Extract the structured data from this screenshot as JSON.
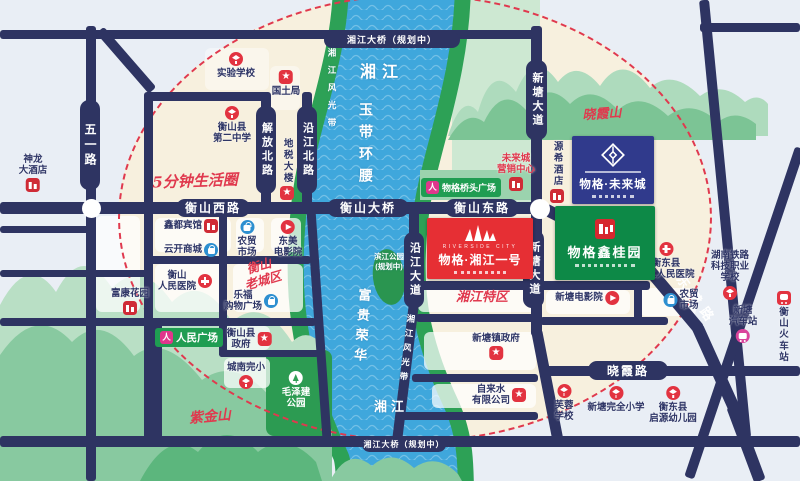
{
  "title": "物格·未来城 区位图",
  "roads": {
    "wuyi": "五一路",
    "jiefangbei": "解放北路",
    "yanjiangbei": "沿江北路",
    "hengshanxi": "衡山西路",
    "hengshanbridge": "衡山大桥",
    "hengshandong": "衡山东路",
    "xintang_n": "新塘大道",
    "xintang_s": "新塘大道",
    "yanjiangda": "沿江大道",
    "xiaoxialu": "晓霞路",
    "dongjianlu": "东健路",
    "xjbridge_top": "湘江大桥（规划中）",
    "xjbridge_bottom": "湘江大桥（规划中）"
  },
  "river": {
    "name_top": "湘江",
    "name_bottom": "湘江",
    "belt_west": "湘江风光带",
    "belt_east": "湘江风光带",
    "yudai": "玉带环腰",
    "fugui": "富贵荣华",
    "island": "滨江公园\n(规划中)"
  },
  "scripts": {
    "five_min": "5分钟生活圈",
    "old_town": "衡山\n老城区",
    "zijinshan": "紫金山",
    "xiaoxiashan": "晓霞山",
    "xjtequ": "湘江特区"
  },
  "projects": {
    "future": {
      "name": "物格·未来城"
    },
    "riverside": {
      "eyebrow": "RIVERSIDE CITY",
      "name": "物格·湘江一号"
    },
    "xingui": {
      "name": "物格鑫桂园"
    }
  },
  "plazas": {
    "renmin": "人民广场",
    "qiaotou": "物格桥头广场"
  },
  "pois": [
    {
      "label": "实验学校",
      "icon": "school",
      "pos": "top",
      "x": 236,
      "y": 52
    },
    {
      "label": "国土局",
      "icon": "star",
      "pos": "top",
      "x": 286,
      "y": 70
    },
    {
      "label": "衡山县\n第二中学",
      "icon": "school",
      "pos": "top",
      "x": 232,
      "y": 106
    },
    {
      "label": "地税大楼",
      "icon": "star",
      "pos": "bottom",
      "x": 287,
      "y": 138,
      "vert": true
    },
    {
      "label": "神龙\n大酒店",
      "icon": "hotel",
      "pos": "bottom",
      "x": 33,
      "y": 154
    },
    {
      "label": "鑫都宾馆",
      "icon": "hotel",
      "pos": "right",
      "x": 191,
      "y": 219
    },
    {
      "label": "云开商城",
      "icon": "shop",
      "pos": "right",
      "x": 191,
      "y": 243
    },
    {
      "label": "农贸\n市场",
      "icon": "shop",
      "pos": "top",
      "x": 247,
      "y": 220
    },
    {
      "label": "东美\n电影院",
      "icon": "cine",
      "pos": "top",
      "x": 288,
      "y": 220
    },
    {
      "label": "衡山\n人民医院",
      "icon": "hosp",
      "pos": "right",
      "x": 185,
      "y": 270
    },
    {
      "label": "乐福\n购物广场",
      "icon": "shop",
      "pos": "right",
      "x": 251,
      "y": 290
    },
    {
      "label": "富康花园",
      "icon": "bldg",
      "pos": "bottom",
      "x": 130,
      "y": 288
    },
    {
      "label": "衡山县\n政府",
      "icon": "star",
      "pos": "right",
      "x": 249,
      "y": 328
    },
    {
      "label": "城南完小",
      "icon": "school",
      "pos": "bottom",
      "x": 246,
      "y": 362
    },
    {
      "label": "毛泽建\n公园",
      "icon": "tree",
      "pos": "top",
      "x": 296,
      "y": 371,
      "cls": "on-green"
    },
    {
      "label": "新塘镇政府",
      "icon": "star",
      "pos": "bottom",
      "x": 496,
      "y": 333
    },
    {
      "label": "自来水\n有限公司",
      "icon": "star",
      "pos": "right",
      "x": 499,
      "y": 384
    },
    {
      "label": "芙蓉\n学校",
      "icon": "school",
      "pos": "top",
      "x": 564,
      "y": 384
    },
    {
      "label": "新塘完全小学",
      "icon": "school",
      "pos": "top",
      "x": 616,
      "y": 386
    },
    {
      "label": "衡东县\n启源幼儿园",
      "icon": "school",
      "pos": "top",
      "x": 673,
      "y": 386
    },
    {
      "label": "新塘电影院",
      "icon": "cine",
      "pos": "right",
      "x": 587,
      "y": 291
    },
    {
      "label": "农贸\n市场",
      "icon": "shop",
      "pos": "left",
      "x": 681,
      "y": 289
    },
    {
      "label": "衡东县\n第二人民医院",
      "icon": "hosp",
      "pos": "top",
      "x": 666,
      "y": 242
    },
    {
      "label": "湖南铁路\n科技职业\n学校",
      "icon": "school",
      "pos": "bottom",
      "x": 730,
      "y": 250
    },
    {
      "label": "新塘\n汽车站",
      "icon": "bus",
      "pos": "bottom",
      "x": 743,
      "y": 305
    },
    {
      "label": "衡山\n火车站",
      "icon": "train",
      "pos": "top",
      "x": 784,
      "y": 291
    },
    {
      "label": "源希酒店",
      "icon": "hotel",
      "pos": "bottom",
      "x": 557,
      "y": 141,
      "vert": true
    },
    {
      "label": "未来城\n营销中心",
      "icon": "bldg",
      "pos": "bottom",
      "x": 516,
      "y": 153,
      "cls": "red"
    }
  ]
}
